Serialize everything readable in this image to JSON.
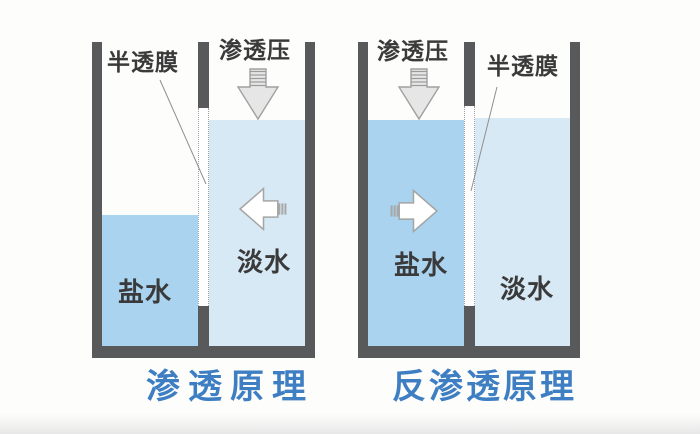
{
  "colors": {
    "wall": "#58595b",
    "salt_water": "#a9d3ee",
    "fresh_water": "#d8e9f6",
    "caption": "#3e7ec3",
    "label": "#3a3a3a",
    "arrow_gray_fill": "#e6e6e6",
    "arrow_white_fill": "#ffffff",
    "arrow_outline": "#a5a5a5"
  },
  "diagrams": [
    {
      "id": "osmosis",
      "caption": "渗透原理",
      "labels": {
        "membrane": "半透膜",
        "pressure": "渗透压",
        "left_chamber": "盐水",
        "right_chamber": "淡水"
      },
      "osmotic_pressure_arrow": "down-on-fresh-water-side",
      "water_flow_arrow": "left-toward-salt-water"
    },
    {
      "id": "reverse-osmosis",
      "caption": "反渗透原理",
      "labels": {
        "membrane": "半透膜",
        "pressure": "渗透压",
        "left_chamber": "盐水",
        "right_chamber": "淡水"
      },
      "osmotic_pressure_arrow": "down-on-salt-water-side",
      "water_flow_arrow": "right-toward-fresh-water"
    }
  ]
}
